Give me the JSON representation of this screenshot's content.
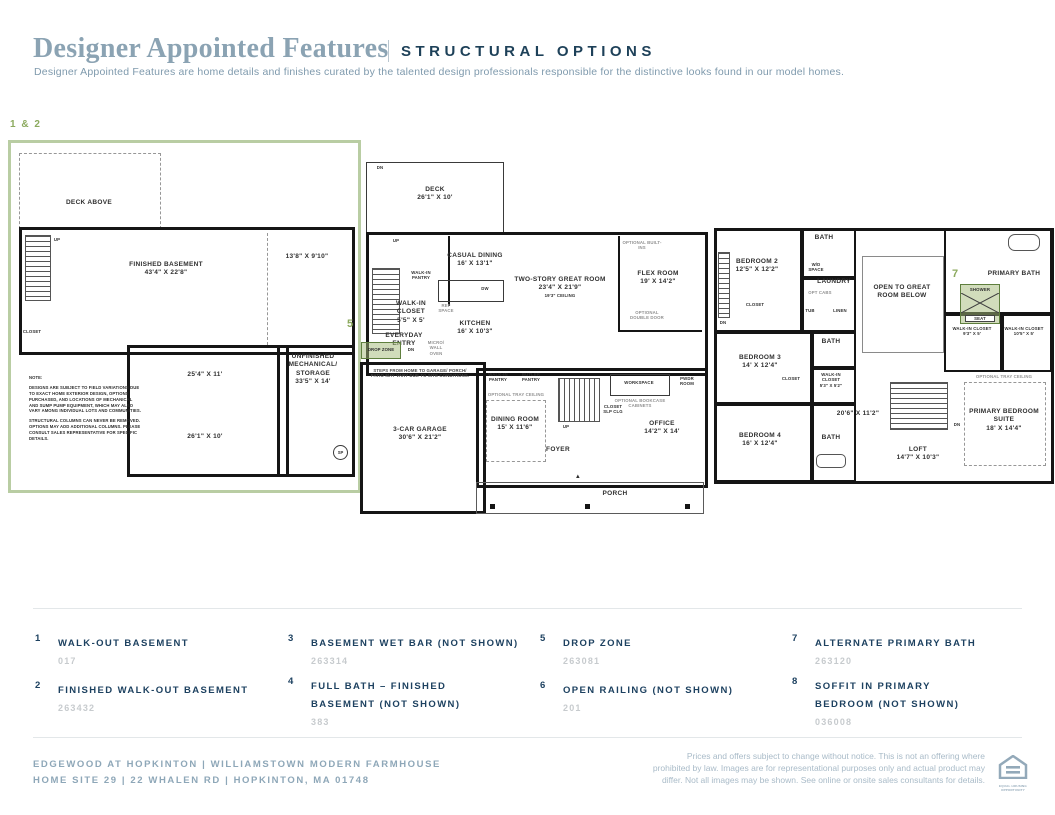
{
  "header": {
    "title": "Designer Appointed Features",
    "tag": "STRUCTURAL OPTIONS",
    "subtitle": "Designer Appointed Features are home details and finishes curated by the talented design professionals responsible for the distinctive looks found in our model homes."
  },
  "colors": {
    "accent_navy": "#1d4160",
    "muted_blue": "#8ba3b3",
    "callout_green": "#8caa5e",
    "highlight_border_green": "#5f7f3e",
    "plan_box_border_green": "#b9cda3",
    "code_gray": "#c7cbce"
  },
  "callouts": {
    "basement": "1 & 2",
    "drop_zone": "5",
    "primary_bath": "7"
  },
  "plans": {
    "basement": {
      "deck_above": "DECK ABOVE",
      "up": "UP",
      "closet": "CLOSET",
      "room": "FINISHED BASEMENT",
      "room_dim": "43'4\" X 22'8\"",
      "side_dim": "13'8\" X 9'10\"",
      "unfinished": "UNFINISHED MECHANICAL/ STORAGE",
      "unfinished_dim": "33'5\" X 14'",
      "mid_dim": "25'4\" X 11'",
      "bottom_dim": "26'1\" X 10'",
      "note_title": "NOTE:",
      "note1": "DESIGNS ARE SUBJECT TO FIELD VARIATIONS DUE TO EXACT HOME EXTERIOR DESIGN, OPTIONS PURCHASED, AND LOCATIONS OF MECHANICAL AND SUMP PUMP EQUIPMENT, WHICH MAY ALSO VARY AMONG INDIVIDUAL LOTS AND COMMUNITIES.",
      "note2": "STRUCTURAL COLUMNS CAN NEVER BE REMOVED. OPTIONS MAY ADD ADDITIONAL COLUMNS. PLEASE CONSULT SALES REPRESENTATIVE FOR SPECIFIC DETAILS.",
      "sp": "SP"
    },
    "first_floor": {
      "deck": "DECK",
      "deck_dim": "26'1\" X 10'",
      "dn": "DN",
      "up": "UP",
      "walk_in_pantry": "WALK-IN PANTRY",
      "casual_dining": "CASUAL DINING",
      "casual_dining_dim": "16' X 13'1\"",
      "walk_in_closet": "WALK-IN CLOSET",
      "walk_in_closet_dim": "5'5\" X 5'",
      "ref_space": "REF SPACE",
      "everyday_entry": "EVERYDAY ENTRY",
      "drop_zone": "DROP ZONE",
      "micro": "MICRO/ WALL OVEN",
      "kitchen": "KITCHEN",
      "kitchen_dim": "16' X 10'3\"",
      "dw": "DW",
      "great_room": "TWO-STORY GREAT ROOM",
      "great_room_dim": "23'4\" X 21'9\"",
      "great_room_ceiling": "19'3\" CEILING",
      "optional_builtins": "OPTIONAL BUILT-INS",
      "flex_room": "FLEX ROOM",
      "flex_room_dim": "19' X 14'2\"",
      "optional_double_door": "OPTIONAL DOUBLE DOOR",
      "workspace": "WORKSPACE",
      "pwdr_room": "PWDR ROOM",
      "optional_bookcase": "OPTIONAL BOOKCASE CABINETS",
      "butler_pantry": "BUTLER PANTRY",
      "optional_tray": "OPTIONAL TRAY CEILING",
      "dining_room": "DINING ROOM",
      "dining_room_dim": "15' X 11'6\"",
      "garage": "3-CAR GARAGE",
      "garage_dim": "30'6\" X 21'2\"",
      "steps_note": "STEPS FROM HOME TO GARAGE/ PORCH/ PATIO MAY VARY DUE TO SITE CONDITIONS.",
      "closet_slp": "CLOSET SLP CLG",
      "office": "OFFICE",
      "office_dim": "14'2\" X 14'",
      "foyer": "FOYER",
      "porch": "PORCH"
    },
    "second_floor": {
      "bath": "BATH",
      "bedroom2": "BEDROOM 2",
      "bedroom2_dim": "12'5\" X 12'2\"",
      "wd_space": "W/D SPACE",
      "laundry": "LAUNDRY",
      "opt_cabs": "OPT CABS",
      "tub": "TUB",
      "linen": "LINEN",
      "closet": "CLOSET",
      "dn": "DN",
      "bedroom3": "BEDROOM 3",
      "bedroom3_dim": "14' X 12'4\"",
      "walk_in_closet": "WALK-IN CLOSET",
      "wic1_dim": "5'3\" X 5'2\"",
      "upper_dim": "20'6\" X 11'2\"",
      "bedroom4": "BEDROOM 4",
      "bedroom4_dim": "16' X 12'4\"",
      "open_to": "OPEN TO GREAT ROOM BELOW",
      "primary_bath": "PRIMARY BATH",
      "shower": "SHOWER",
      "seat": "SEAT",
      "wic2_dim": "9'3\" X 5'",
      "wic3_dim": "10'5\" X 5'",
      "optional_tray": "OPTIONAL TRAY CEILING",
      "primary_suite": "PRIMARY BEDROOM SUITE",
      "primary_suite_dim": "18' X 14'4\"",
      "loft": "LOFT",
      "loft_dim": "14'7\" X 10'3\""
    }
  },
  "legend": {
    "items": [
      {
        "num": "1",
        "title": "WALK-OUT BASEMENT",
        "code": "017"
      },
      {
        "num": "2",
        "title": "FINISHED WALK-OUT BASEMENT",
        "code": "263432"
      },
      {
        "num": "3",
        "title": "BASEMENT WET BAR (NOT SHOWN)",
        "code": "263314"
      },
      {
        "num": "4",
        "title": "FULL BATH – FINISHED BASEMENT (NOT SHOWN)",
        "code": "383"
      },
      {
        "num": "5",
        "title": "DROP ZONE",
        "code": "263081"
      },
      {
        "num": "6",
        "title": "OPEN RAILING (NOT SHOWN)",
        "code": "201"
      },
      {
        "num": "7",
        "title": "ALTERNATE PRIMARY BATH",
        "code": "263120"
      },
      {
        "num": "8",
        "title": "SOFFIT IN PRIMARY BEDROOM (NOT SHOWN)",
        "code": "036008"
      }
    ]
  },
  "footer": {
    "community": "EDGEWOOD AT HOPKINTON   |   WILLIAMSTOWN MODERN FARMHOUSE",
    "site": "HOME SITE 29   |   22 WHALEN RD   |   HOPKINTON, MA 01748",
    "disclaimer": "Prices and offers subject to change without notice. This is not an offering where prohibited by law. Images are for representational purposes only and actual product may differ. Not all images may be shown. See online or onsite sales consultants for details.",
    "eho": "EQUAL HOUSING OPPORTUNITY"
  }
}
